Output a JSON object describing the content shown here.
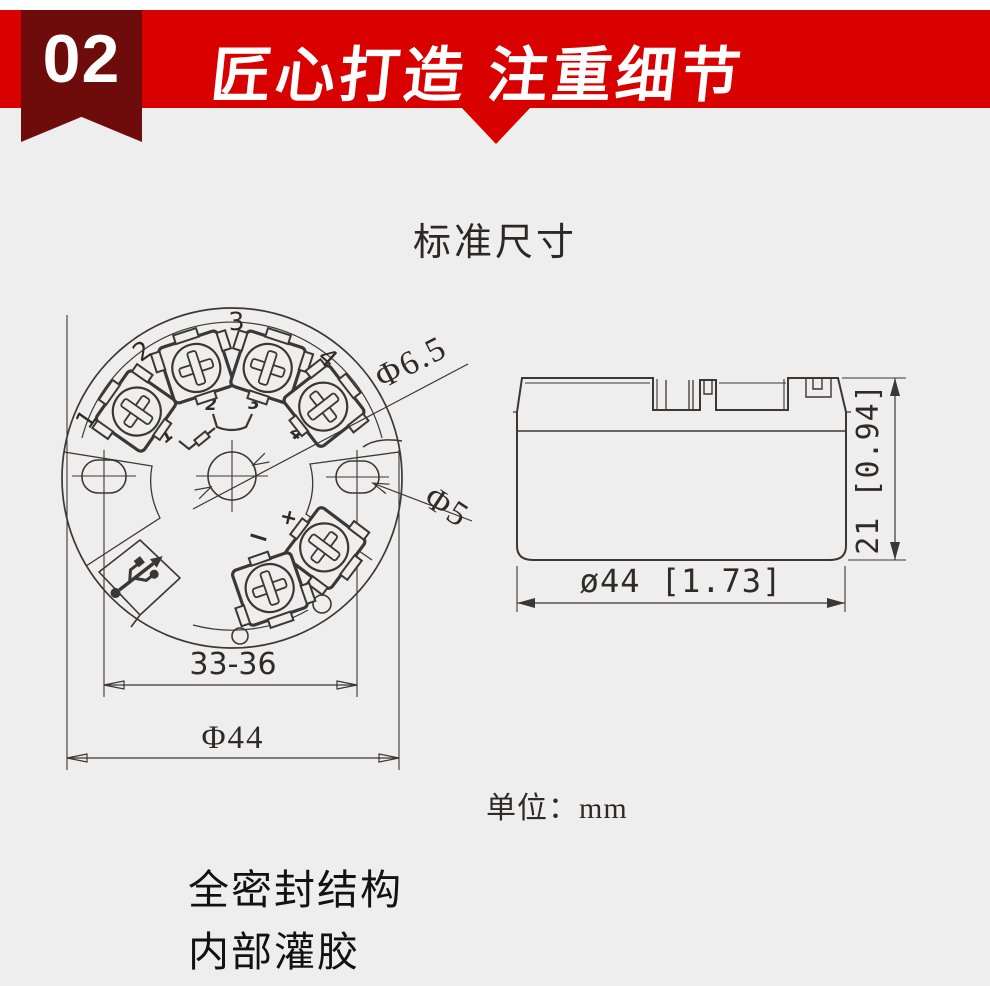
{
  "header": {
    "badge": "02",
    "title": "匠心打造 注重细节"
  },
  "section_title": "标准尺寸",
  "top_view": {
    "outer_terminal_labels": [
      "1",
      "2",
      "3",
      "4"
    ],
    "wiring_labels": [
      "1",
      "2",
      "3",
      "4"
    ],
    "plus": "+",
    "minus": "−",
    "dim_center_hole": "Φ6.5",
    "dim_side_hole": "Φ5",
    "dim_hole_span": "33-36",
    "dim_diameter": "Φ44"
  },
  "side_view": {
    "dim_height": "21 [0.94]",
    "dim_diameter": "ø44 [1.73]"
  },
  "unit_note": "单位：mm",
  "features": [
    "全密封结构",
    "内部灌胶"
  ],
  "colors": {
    "banner_red": "#d90000",
    "ribbon_maroon": "#6e0b0b",
    "background": "#efeeee",
    "line": "#3b3735"
  }
}
